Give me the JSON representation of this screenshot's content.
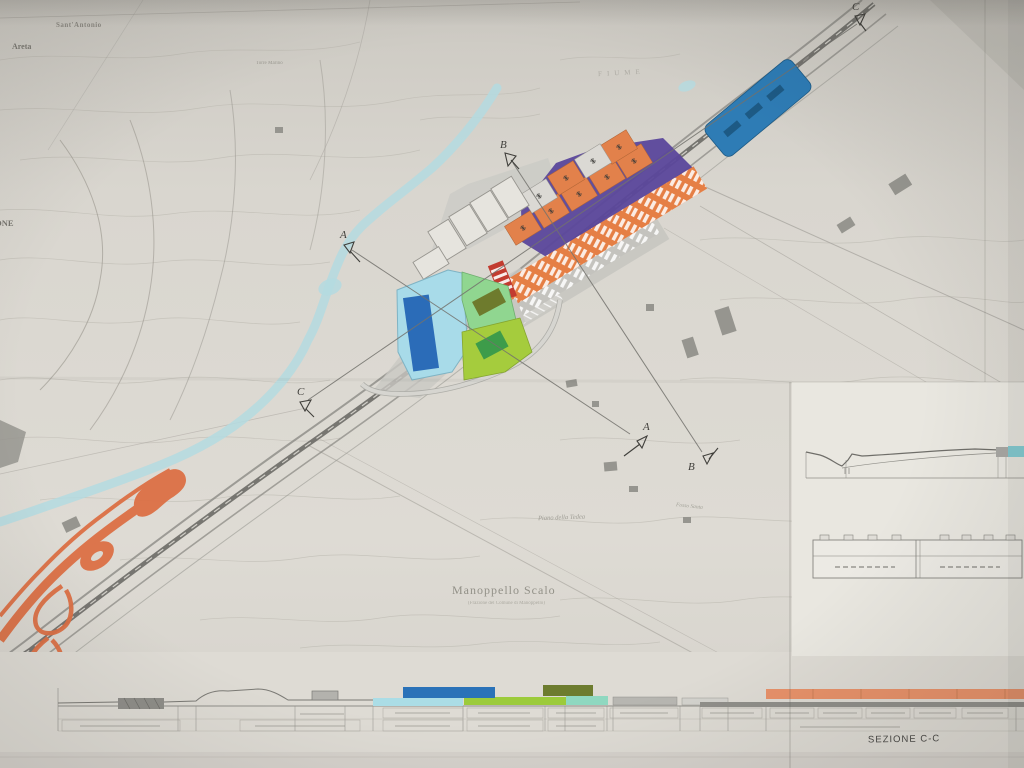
{
  "map_labels": {
    "sant_antonio": "Sant'Antonio",
    "areta": "Areta",
    "torre_marino": "Torre Marino",
    "left_edge_partial": "AZIONE",
    "fiume": "FIUME",
    "manoppello_scalo": "Manoppello Scalo",
    "manoppello_sub": "(Frazione del Comune di Manoppello)",
    "piano_della_tedea": "Piano della Tedea",
    "fosso_santa": "Fosso Santa"
  },
  "section_markers": {
    "a": "A",
    "b": "B",
    "c": "C"
  },
  "bottom_section": {
    "title": "SEZIONE C-C"
  },
  "colors": {
    "paper": "#d9d6cf",
    "river": "#b4dbe1",
    "zone_purple": "#5b479b",
    "building_orange": "#e2814b",
    "strip_orange": "#e57f45",
    "gray_strip": "#c4c3be",
    "terminal_blue": "#2e7cb5",
    "pool_area_cyan": "#a8dbe9",
    "pool_blue": "#2b6cb8",
    "green_light": "#90d690",
    "green_olive": "#6e7b2d",
    "green_yellow": "#a5cc3d",
    "green_dark": "#3d9c4a",
    "red_building": "#c23b30",
    "interchange_orange": "#dc7045",
    "section_blue": "#2a72b8",
    "section_cyan": "#abdde6",
    "section_green": "#9ccb3b",
    "section_olive": "#6d7c2f",
    "section_teal": "#8fd8c0",
    "section_salmon": "#e8926a",
    "inset_cyan": "#84cdd3"
  }
}
